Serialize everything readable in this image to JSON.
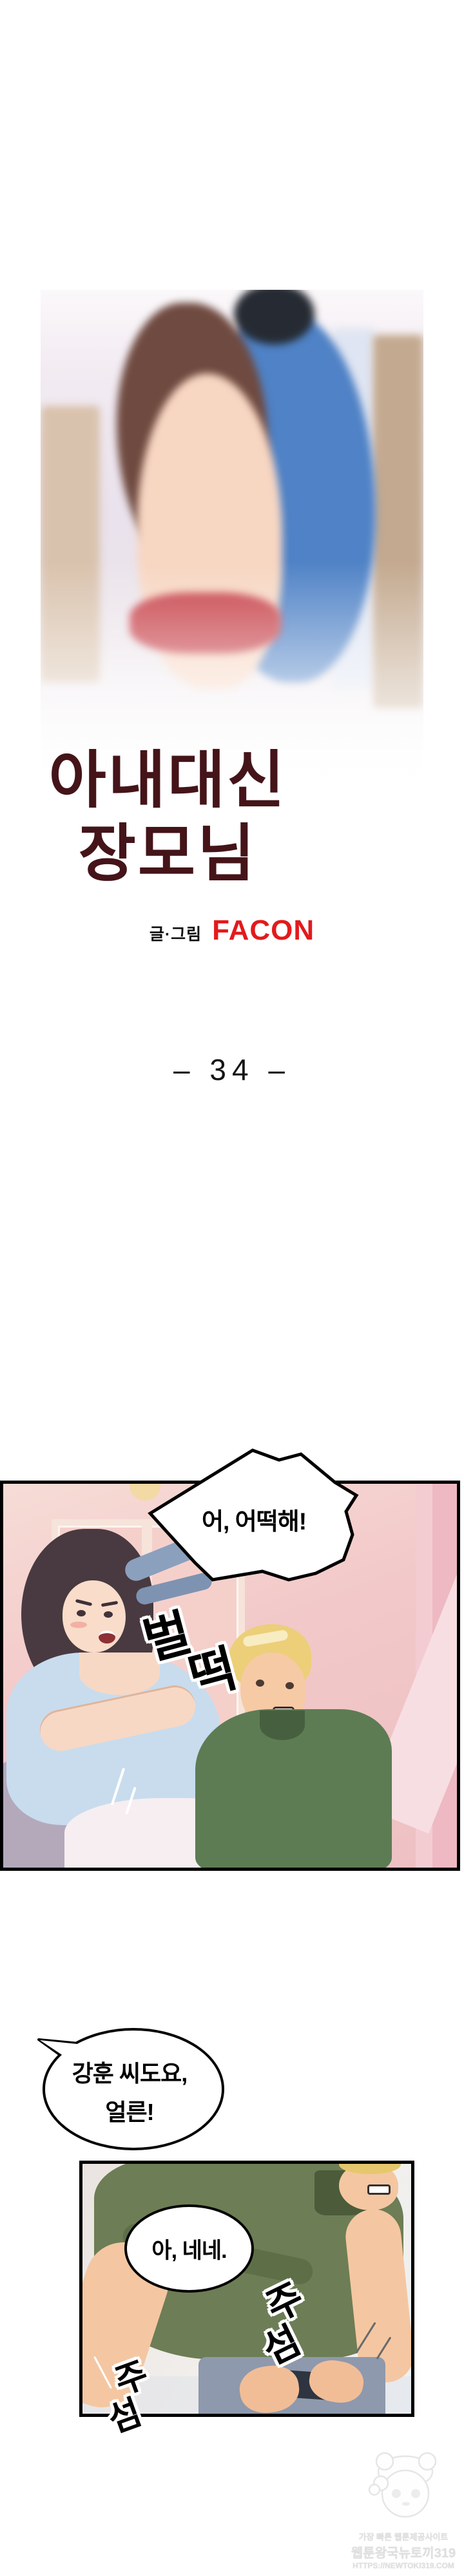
{
  "cover": {
    "art_label": "cover-illustration-couple-embrace",
    "title_line1": "아내대신",
    "title_line2": "장모님",
    "title_color": "#441419",
    "credit_label": "글·그림",
    "credit_author": "FACON",
    "credit_author_color": "#e31a1c"
  },
  "chapter": {
    "label": "–  34  –"
  },
  "panel1": {
    "art_label": "living-room-woman-clutching-blouse-and-startled-man",
    "bubble_text": "어, 어떡해!",
    "sfx": {
      "char1": "벌",
      "char2": "떡",
      "reading": "벌떡"
    }
  },
  "floating_bubble": {
    "line1": "강훈 씨도요,",
    "line2": "얼른!"
  },
  "panel2": {
    "art_label": "man-in-olive-polo-fastening-belt",
    "bubble_text": "아, 네네.",
    "sfx_a": {
      "char1": "주",
      "char2": "섬",
      "reading": "주섬"
    },
    "sfx_b": {
      "char1": "주",
      "char2": "섬",
      "reading": "주섬"
    }
  },
  "watermark": {
    "mascot_label": "newtoki-rabbit-girl-mascot",
    "line1": "가장 빠른 웹툰제공사이트",
    "line2": "웹툰왕국뉴토끼319",
    "line3": "HTTPS://NEWTOKI319.COM",
    "color": "#e0e0e0"
  }
}
